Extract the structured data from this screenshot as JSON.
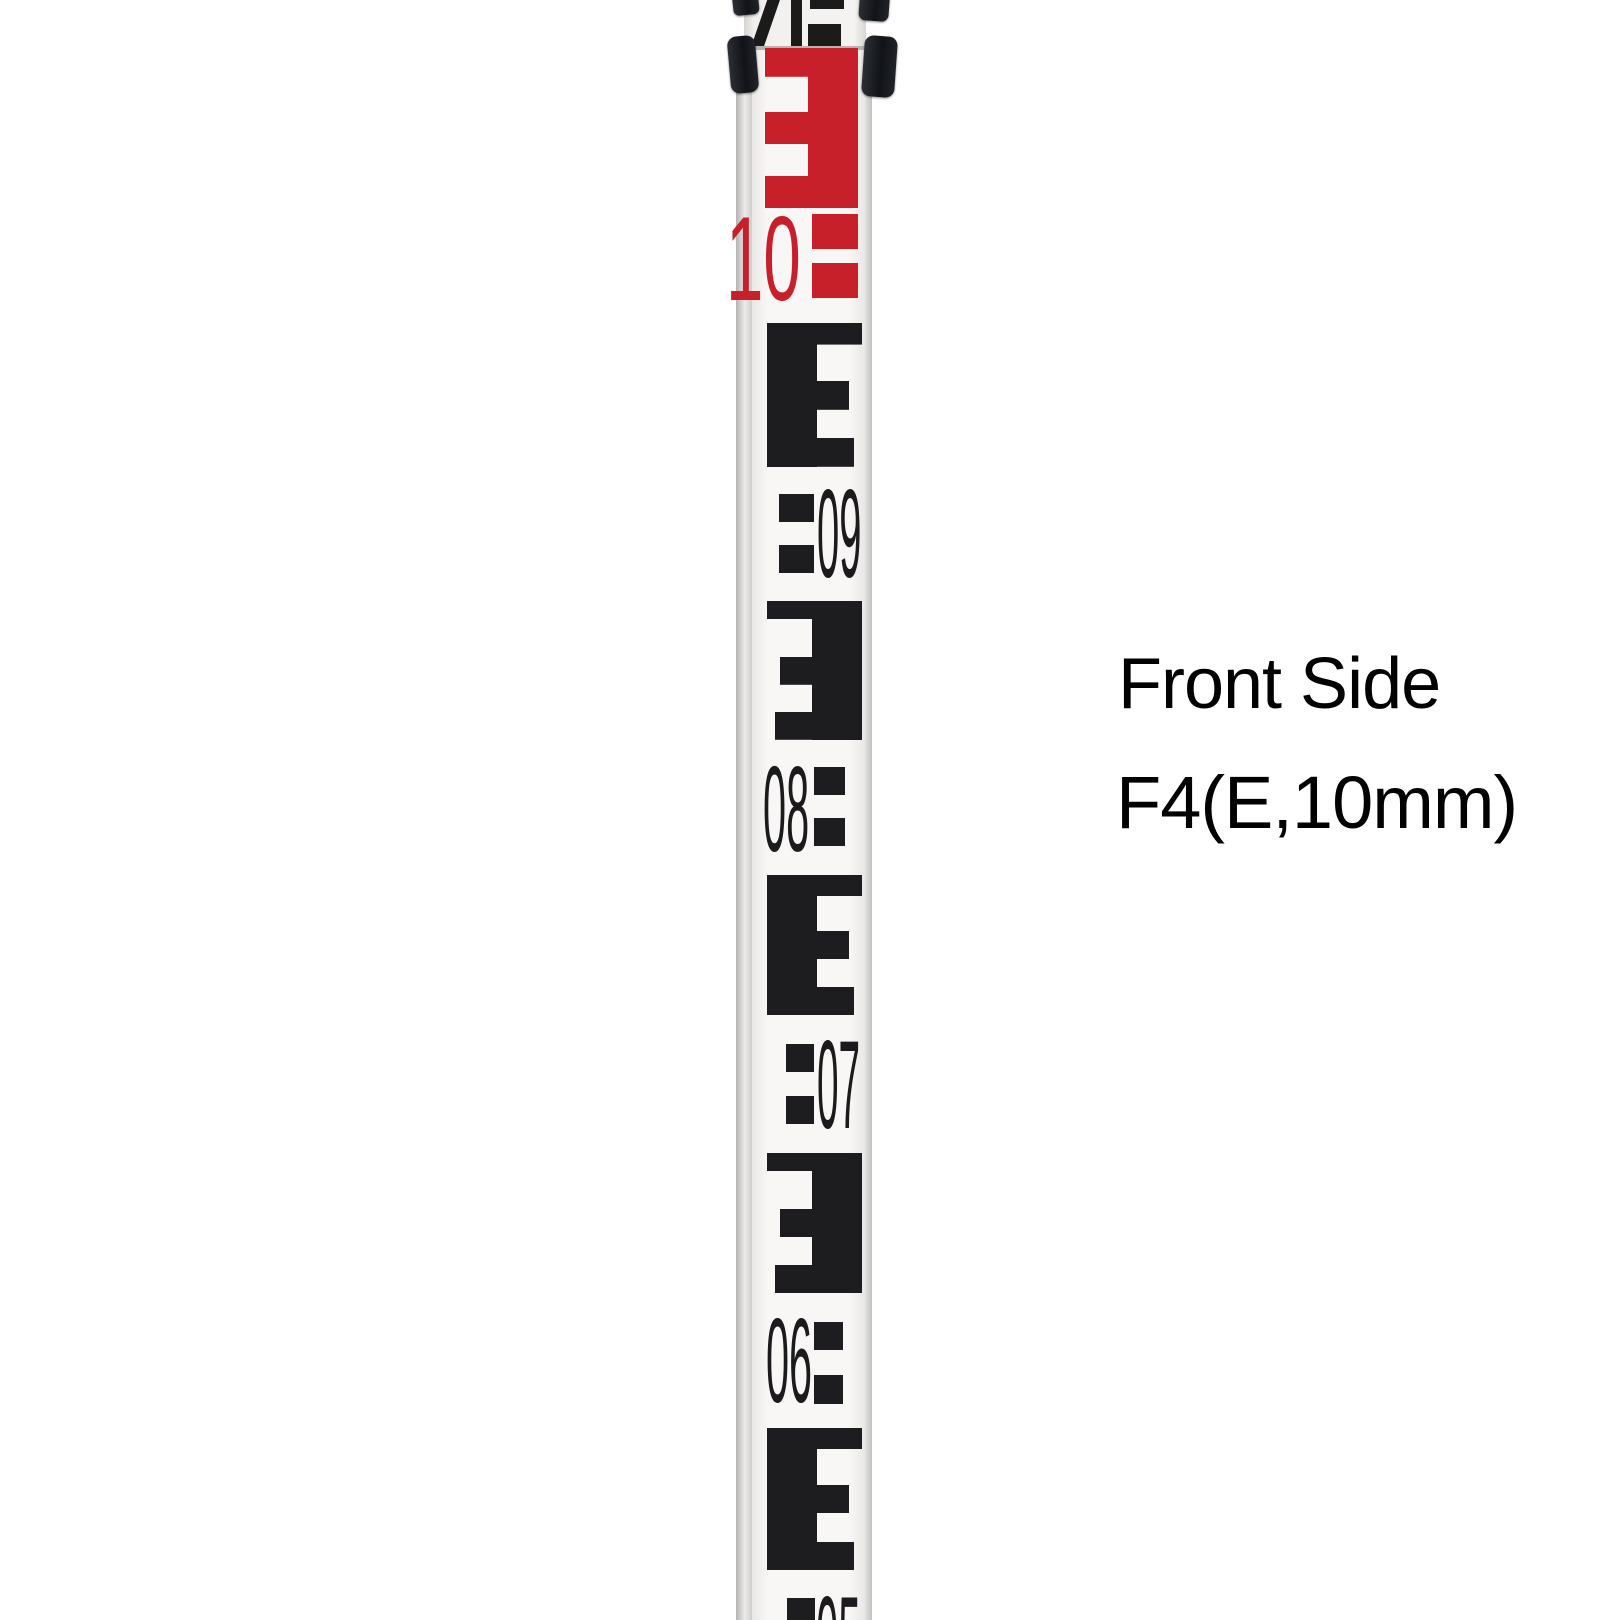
{
  "photo": {
    "subject": "Telescopic surveying leveling staff, front side, E-pattern 10 mm graduations",
    "background_color": "#ffffff"
  },
  "caption": {
    "line1": "Front Side",
    "line2": "F4(E,10mm)",
    "text_color": "#000000"
  },
  "staff": {
    "pattern_name": "E",
    "colors": {
      "red": "#c8202a",
      "black": "#1d1c1e",
      "face": "#f8f7f5",
      "clamp": "#16181d"
    },
    "numbers": [
      {
        "label": "10",
        "color": "red"
      },
      {
        "label": "09",
        "color": "black"
      },
      {
        "label": "08",
        "color": "black"
      },
      {
        "label": "07",
        "color": "black"
      },
      {
        "label": "06",
        "color": "black"
      },
      {
        "label": "05",
        "color": "black"
      }
    ]
  }
}
